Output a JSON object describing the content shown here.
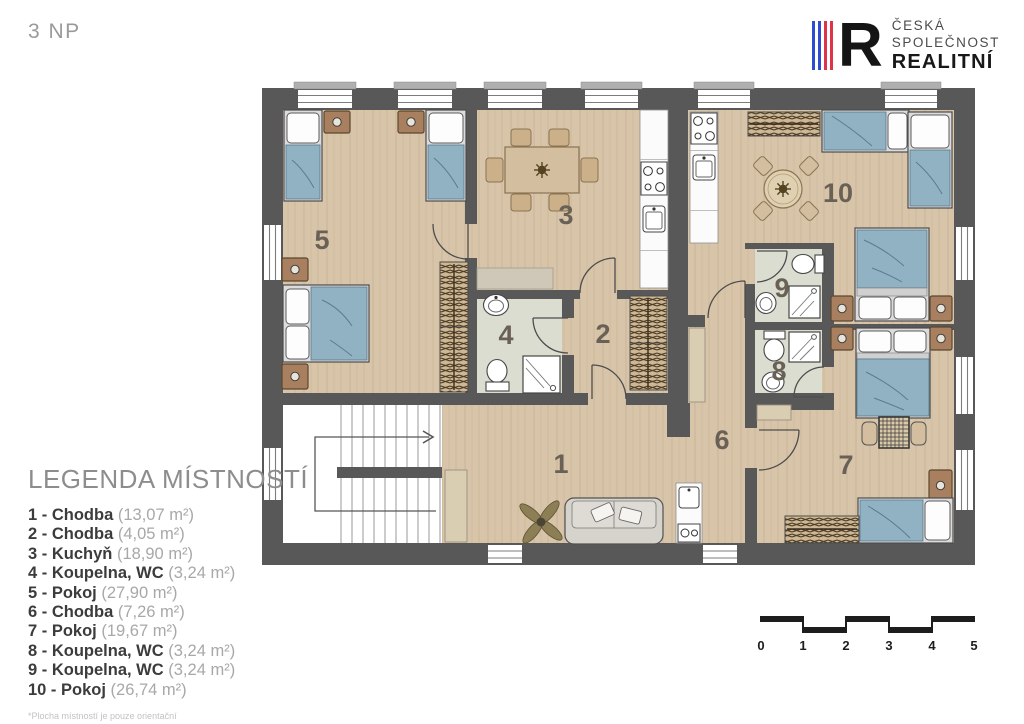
{
  "header": {
    "floor_label": "3 NP"
  },
  "logo": {
    "letter": "R",
    "line1": "ČESKÁ",
    "line2": "SPOLEČNOST",
    "line3": "REALITNÍ",
    "stripes": [
      "#2d4ecf",
      "#2d4ecf",
      "#e03347",
      "#e03347"
    ]
  },
  "legend": {
    "title": "LEGENDA MÍSTNOSTÍ",
    "items": [
      {
        "label": "1 - Chodba",
        "area": "(13,07 m²)"
      },
      {
        "label": "2 - Chodba",
        "area": "(4,05 m²)"
      },
      {
        "label": "3 - Kuchyň",
        "area": "(18,90 m²)"
      },
      {
        "label": "4 - Koupelna, WC",
        "area": "(3,24 m²)"
      },
      {
        "label": "5 - Pokoj",
        "area": "(27,90 m²)"
      },
      {
        "label": "6 - Chodba",
        "area": "(7,26 m²)"
      },
      {
        "label": "7 - Pokoj",
        "area": "(19,67 m²)"
      },
      {
        "label": "8 - Koupelna, WC",
        "area": "(3,24 m²)"
      },
      {
        "label": "9 - Koupelna, WC",
        "area": "(3,24 m²)"
      },
      {
        "label": "10 - Pokoj",
        "area": "(26,74 m²)"
      }
    ],
    "footnote": "*Plocha místností je pouze orientační"
  },
  "plan": {
    "room_numbers": [
      "1",
      "2",
      "3",
      "4",
      "5",
      "6",
      "7",
      "8",
      "9",
      "10"
    ]
  },
  "scalebar": {
    "labels": [
      "0",
      "1",
      "2",
      "3",
      "4",
      "5"
    ]
  },
  "colors": {
    "wall": "#585858",
    "floor_wood": "#d8c5a9",
    "floor_bath": "#dcddd1",
    "bed": "#90b2c3",
    "logo_blue": "#2d4ecf",
    "logo_red": "#e03347",
    "scalebar": "#1d1d1d"
  }
}
